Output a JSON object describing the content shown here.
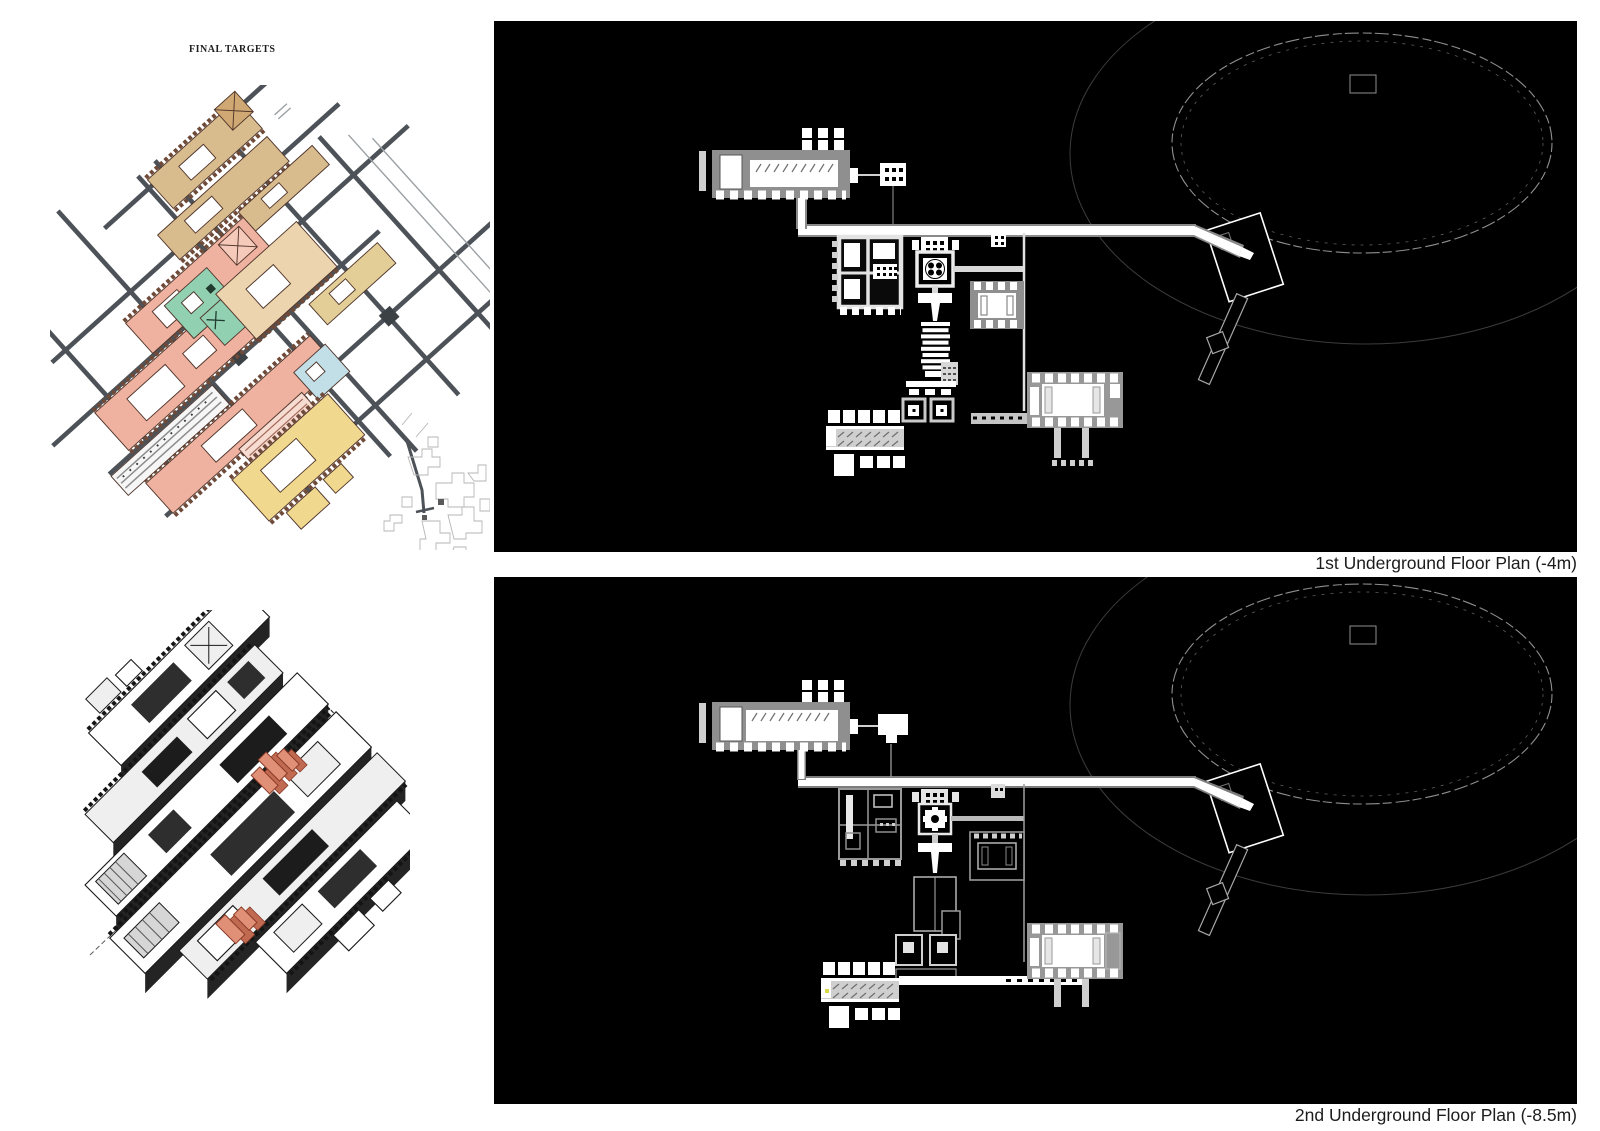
{
  "page": {
    "background_color": "#ffffff"
  },
  "masterplan": {
    "title": "FINAL TARGETS",
    "palette": {
      "tan": "#d8bc8e",
      "salmon": "#f0b2a0",
      "teal": "#92d0b2",
      "light_blue": "#c2dfe8",
      "yellow": "#f1d88f",
      "pink_stripe": "#f7dcd2",
      "road_gray": "#4c5257",
      "outline_brown": "#4e342a"
    }
  },
  "axonometric": {
    "accent_color": "#e09077",
    "ink_color": "#1a1a1a"
  },
  "panels": [
    {
      "caption": "1st Underground Floor Plan (-4m)",
      "background": "#000000",
      "ink": "#ffffff"
    },
    {
      "caption": "2nd Underground Floor Plan (-8.5m)",
      "background": "#000000",
      "ink": "#ffffff"
    }
  ]
}
